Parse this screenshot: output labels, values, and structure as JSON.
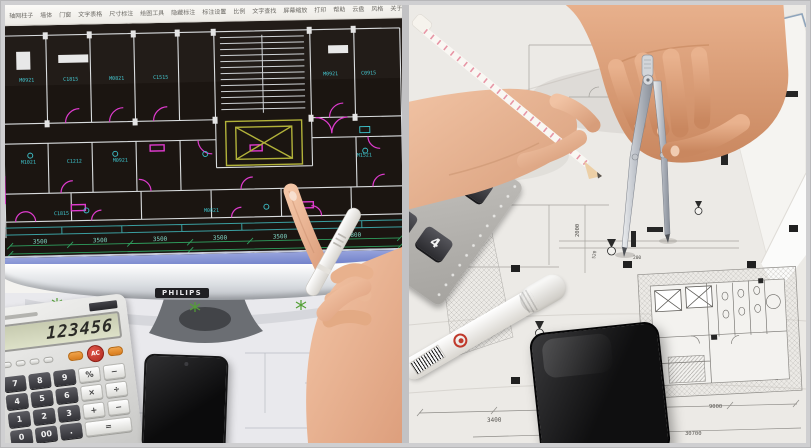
{
  "left_photo": {
    "monitor_brand": "PHILIPS",
    "cad_toolbar": {
      "items": [
        "轴网柱子",
        "墙体",
        "门窗",
        "文字表格",
        "尺寸标注",
        "绘图工具",
        "隐藏标注",
        "标注设置",
        "比例",
        "文字查找",
        "屏幕缩放",
        "打印",
        "帮助",
        "云盘",
        "风格",
        "关于",
        "素材"
      ]
    },
    "cad": {
      "labels": [
        "M0921",
        "C1815",
        "M0821",
        "C1515",
        "M0921",
        "C0915",
        "M1021",
        "C1212",
        "M0921",
        "M1521",
        "C1815",
        "M0821"
      ],
      "dims": [
        "3500",
        "3500",
        "3500",
        "3500",
        "3500",
        "7800"
      ],
      "dim_total": "56900"
    },
    "calculator": {
      "display": "123456",
      "ac": "AC",
      "keys": [
        "7",
        "8",
        "9",
        "%",
        "−",
        "4",
        "5",
        "6",
        "×",
        "÷",
        "1",
        "2",
        "3",
        "+",
        "−",
        "0",
        "00",
        "."
      ],
      "equals": "="
    }
  },
  "right_photo": {
    "blueprint_dims": {
      "d1": "3400",
      "d2": "9000",
      "d3": "30700",
      "v1": "2000",
      "v2": "520",
      "v3": "200"
    },
    "calculator_keys": [
      "0",
      "0",
      "1",
      "4"
    ]
  },
  "colors": {
    "cad_background": "#1b1511",
    "cad_wall": "#d9dcde",
    "cad_magenta": "#df3bce",
    "cad_cyan": "#3fc6cf",
    "cad_dim_green": "#2f9e5e",
    "cad_elevator_yellow": "#b2b23a",
    "command_bar_blue": "#7e8ed2",
    "blueprint_paper": "#e9e7e3"
  }
}
